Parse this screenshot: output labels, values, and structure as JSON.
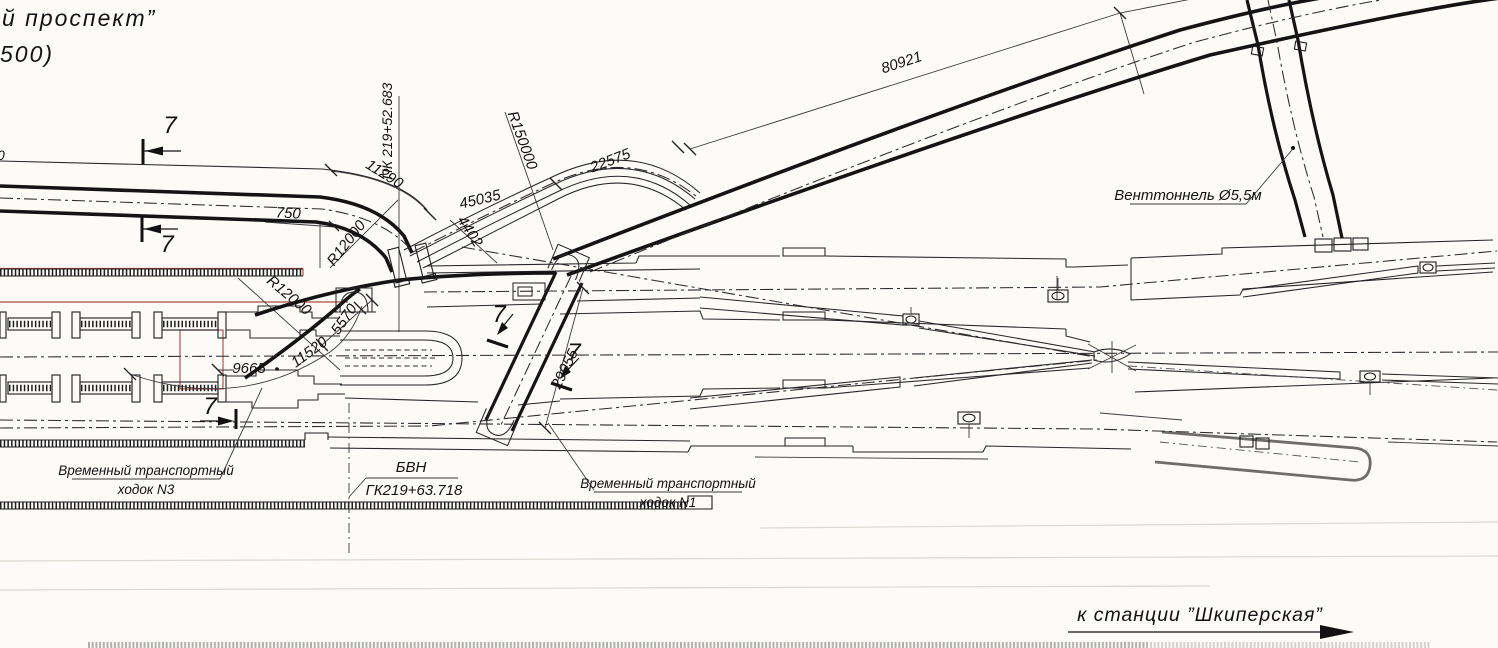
{
  "meta": {
    "paper_color": "#fcfbf7",
    "ink_color": "#26262a",
    "red_color": "#b24a43",
    "drawing_type": "metro tunnel junction plan"
  },
  "header": {
    "fragment_line1": "й  проспект”",
    "fragment_line2": "500)",
    "left_edge_fragment": "0"
  },
  "labels": {
    "pk_top": "ПК 219+52.683",
    "bvn_title": "БВН",
    "bvn_value": "ГК219+63.718",
    "vent": "Венттоннель Ø5,5м",
    "passage3_line1": "Временный транспортный",
    "passage3_line2": "ходок N3",
    "passage1_line1": "Временный транспортный",
    "passage1_line2": "ходок N1",
    "direction": "к  станции  ”Шкиперская”"
  },
  "dimensions": {
    "d750": "750",
    "d11290": "11290",
    "r12000a": "R12000",
    "r12000b": "R12000",
    "d5570": "5570",
    "d11520": "11520",
    "d9665": "9665",
    "d45035": "45035",
    "d4402": "4402",
    "r150000": "R150000",
    "d22575": "22575",
    "d80921": "80921",
    "d29055": "29055"
  },
  "section_marks": {
    "s1": "7",
    "s2": "7",
    "s3": "7",
    "s4": "7",
    "s5": "7"
  }
}
